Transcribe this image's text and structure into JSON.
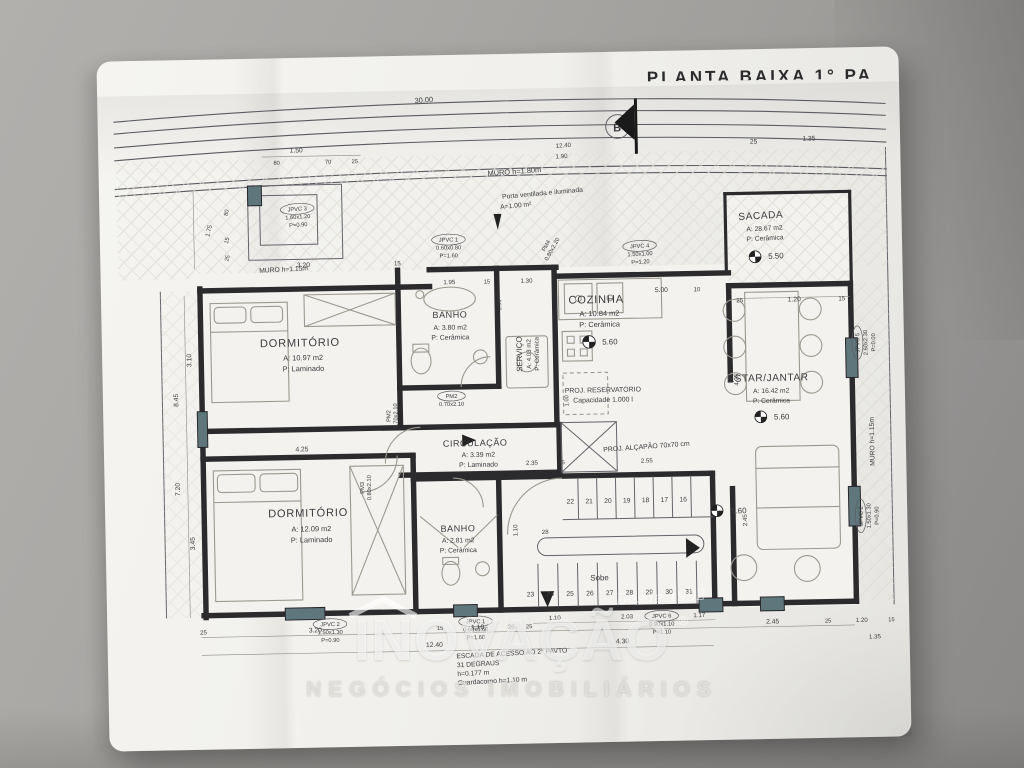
{
  "title": "PLANTA BAIXA 1° PA",
  "marker_b": "B",
  "walls": {
    "muro_top": "MURO h=1.80m",
    "muro_left": "MURO h=1.15m",
    "muro_right": "MURO h=1.15m"
  },
  "rooms": {
    "dorm1": {
      "name": "DORMITÓRIO",
      "area": "A: 10.97 m2",
      "floor": "P: Laminado"
    },
    "banho1": {
      "name": "BANHO",
      "area": "A: 3.80 m2",
      "floor": "P: Cerâmica"
    },
    "servico": {
      "name": "SERVIÇO",
      "area": "A: 4.03 m2",
      "floor": "P: Cerâmica"
    },
    "cozinha": {
      "name": "COZINHA",
      "area": "A: 10.84 m2",
      "floor": "P: Cerâmica",
      "level": "5.60"
    },
    "sacada": {
      "name": "SACADA",
      "area": "A: 28.67 m2",
      "floor": "P: Cerâmica",
      "level": "5.50"
    },
    "estar": {
      "name": "ESTAR/JANTAR",
      "area": "A: 16.42 m2",
      "floor": "P: Cerâmica",
      "level": "5.60"
    },
    "circ": {
      "name": "CIRCULAÇÃO",
      "area": "A: 3.39 m2",
      "floor": "P: Laminado"
    },
    "dorm2": {
      "name": "DORMITÓRIO",
      "area": "A: 12.09 m2",
      "floor": "P: Laminado"
    },
    "banho2": {
      "name": "BANHO",
      "area": "A: 2.81 m2",
      "floor": "P: Cerâmica"
    }
  },
  "openings": {
    "jpvc1a": {
      "tag": "JPVC 1",
      "size": "0.60x0.80",
      "sill": "P=1.60"
    },
    "jpvc1b": {
      "tag": "JPVC 1",
      "size": "0.60x0.60",
      "sill": "P=1.60"
    },
    "jpvc2a": {
      "tag": "JPVC 2",
      "size": "1.50x1.30",
      "sill": "P=0.90"
    },
    "jpvc2b": {
      "tag": "JPVC 2",
      "size": "1.50x1.30",
      "sill": "P=0.90"
    },
    "jpvc3": {
      "tag": "JPVC 3",
      "size": "1.60x1.20",
      "sill": "P=0.90"
    },
    "jpvc4": {
      "tag": "JPVC 4",
      "size": "1.50x1.00",
      "sill": "P=1.20"
    },
    "jpvc5": {
      "tag": "JPVC 5",
      "size": "2.60x2.30",
      "sill": "P=0.00"
    },
    "jpvc6": {
      "tag": "JPVC 6",
      "size": "0.90x1.10",
      "sill": "P=1.10"
    },
    "pm2a": {
      "tag": "PM2",
      "size": "0.70x2.10"
    },
    "pm2b": {
      "tag": "PM2",
      "size": "0.70x2.10"
    },
    "pm3": {
      "tag": "PM3",
      "size": "0.80x2.10"
    },
    "pm4": {
      "tag": "PM4",
      "size": "0.80x2.20"
    }
  },
  "annotations": {
    "porta1": "Porta ventilada e iluminada",
    "porta2": "A=1.00 m²",
    "res1": "PROJ. RESERVATÓRIO",
    "res2": "Capacidade 1.000 l",
    "alcapao": "PROJ. ALÇAPÃO 70x70 cm",
    "escada1": "ESCADA DE ACESSO AO 2° PAVTO",
    "escada2": "31 DEGRAUS",
    "escada3": "h=0.177 m",
    "escada4": "Guardacorpo h=1.10 m",
    "sobe": "Sobe",
    "level_stair": "5.60"
  },
  "dims": {
    "lot_width": "30.00",
    "top": [
      "1.50",
      "80",
      "70",
      "25",
      "12.40",
      "1.90",
      "25",
      "1.35"
    ],
    "left": [
      "1.75",
      "80",
      "15",
      "25",
      "3.10",
      "8.45",
      "7.20",
      "3.45"
    ],
    "inner_top": [
      "3.20",
      "15",
      "1.95",
      "1.30",
      "5.00",
      "10",
      "15"
    ],
    "mid": [
      "4.25",
      "2.35",
      "15",
      "2.55",
      "1.00",
      "1.10",
      "1.96",
      "4.25",
      "2.45"
    ],
    "sacada_bottom": [
      "25",
      "1.20",
      "15"
    ],
    "bottom": [
      "25",
      "3.20",
      "15",
      "1.10",
      "20",
      "25",
      "1.10",
      "2.03",
      "1.17",
      "4.30",
      "12.40",
      "2.45",
      "25",
      "1.20",
      "15",
      "1.35"
    ]
  },
  "stairs": {
    "top": [
      "22",
      "21",
      "20",
      "19",
      "18",
      "17",
      "16"
    ],
    "bottom": [
      "23",
      "24",
      "25",
      "26",
      "27",
      "28",
      "29",
      "30",
      "31"
    ],
    "turn": "28"
  },
  "watermark": {
    "brand_bold": "INO",
    "brand_rest": "VAÇÃO",
    "registered": "®",
    "since": "Desde 1992",
    "tagline": "NEGÓCIOS IMOBILIÁRIOS"
  }
}
